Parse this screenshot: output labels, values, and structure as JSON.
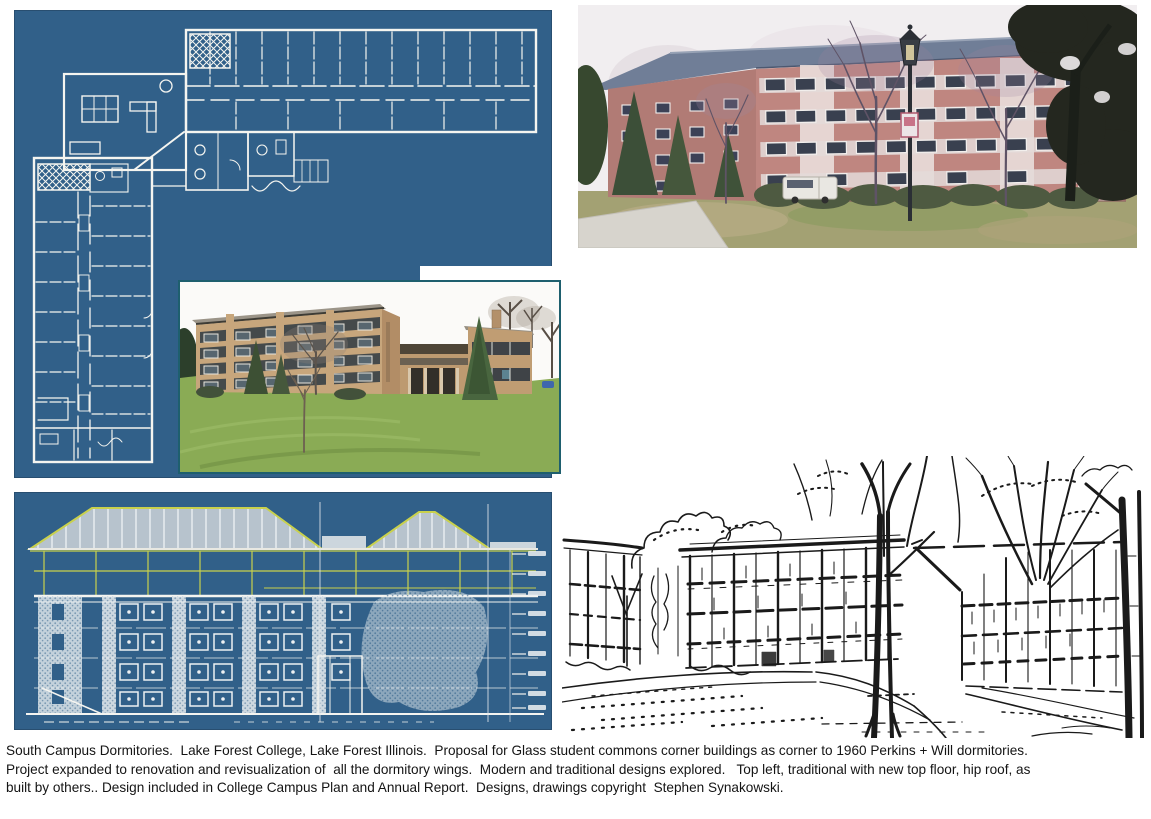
{
  "caption": {
    "lines": [
      "South Campus Dormitories.  Lake Forest College, Lake Forest Illinois.  Proposal for Glass student commons corner buildings as corner to 1960 Perkins + Will dormitories.",
      "Project expanded to renovation and revisualization of  all the dormitory wings.  Modern and traditional designs explored.   Top left, traditional with new top floor, hip roof, as",
      "built by others.. Design included in College Campus Plan and Annual Report.  Designs, drawings copyright  Stephen Synakowski."
    ]
  },
  "figures": {
    "floor_plan_panel": "l-shaped-dormitory-floor-plan-blueprint",
    "photo_top_right": "red-brick-dormitory-photo",
    "photo_middle": "tan-brick-dormitory-photo",
    "elevation_panel": "dormitory-elevation-blueprint-hip-roof",
    "sketch": "ink-perspective-sketch-of-dormitories"
  },
  "colors": {
    "page_background": "#ffffff",
    "blueprint_background": "#316089",
    "blueprint_line": "#f5f5f0",
    "highlight_yellow": "#c9d14c",
    "roof_fill": "#b7c3cd",
    "photo_border_teal": "#1e5f6e",
    "ink": "#1a1a1a",
    "caption_text": "#141414"
  }
}
